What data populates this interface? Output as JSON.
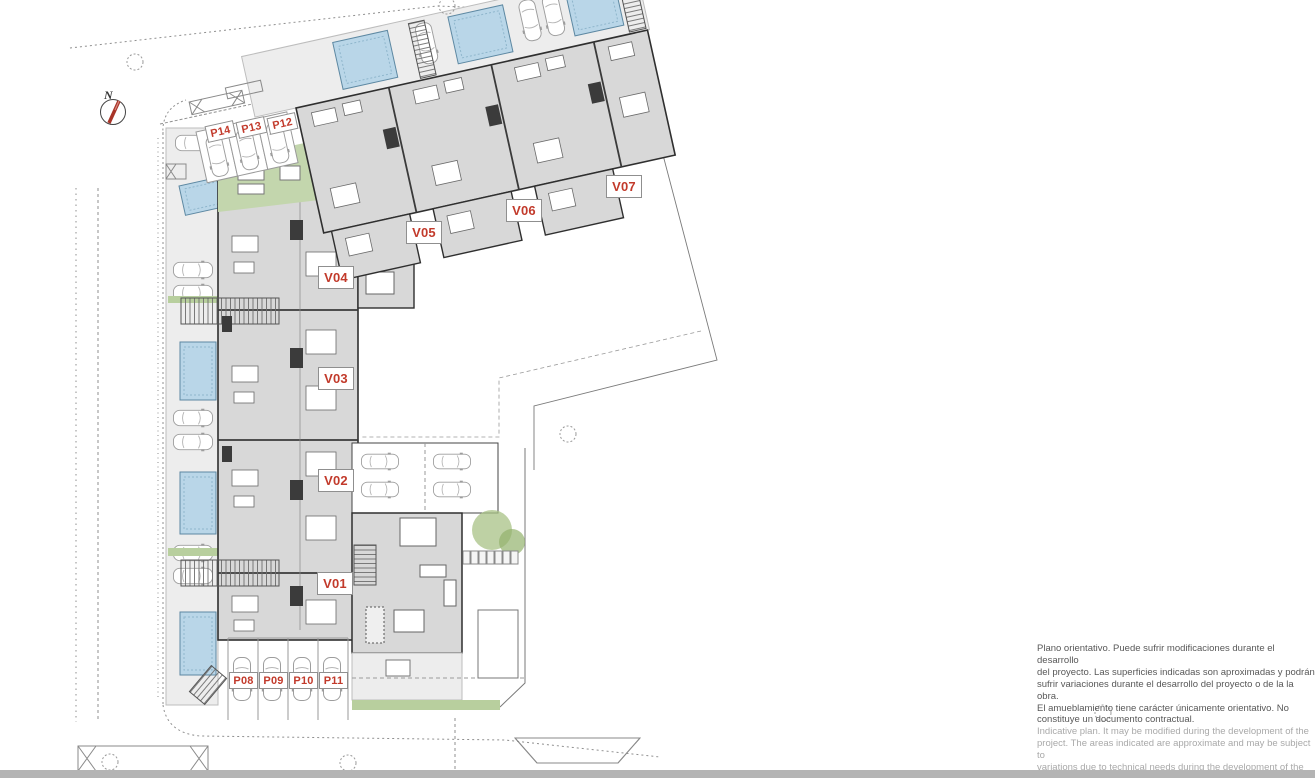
{
  "plan": {
    "compass": {
      "label": "N"
    },
    "units": [
      {
        "id": "V01"
      },
      {
        "id": "V02"
      },
      {
        "id": "V03"
      },
      {
        "id": "V04"
      },
      {
        "id": "V05"
      },
      {
        "id": "V06"
      },
      {
        "id": "V07"
      }
    ],
    "parking_top": [
      "P14",
      "P13",
      "P12"
    ],
    "parking_bottom": [
      "P08",
      "P09",
      "P10",
      "P11"
    ],
    "colors": {
      "label_red": "#c23a2b",
      "pool_blue": "#b9d6e8",
      "building_gray": "#d8d8d8",
      "vegetation_green": "#b8cf9e",
      "bottom_bar_gray": "#b4b4b4"
    }
  },
  "disclaimer": {
    "es": [
      "Plano orientativo. Puede sufrir modificaciones durante el desarrollo",
      "del proyecto. Las superficies indicadas son aproximadas y podrán",
      "sufrir variaciones durante el desarrollo del proyecto o de la la obra.",
      "El amueblamiento tiene carácter únicamente orientativo. No",
      "constituye un documento contractual."
    ],
    "en": [
      "Indicative plan. It may be modified during the development of the",
      "project. The areas indicated are approximate and may be subject to",
      "variations due to technical needs during the development of the",
      "project or the work. The furnishings are for guidance only. It does",
      "not constitute a contractual document."
    ]
  }
}
